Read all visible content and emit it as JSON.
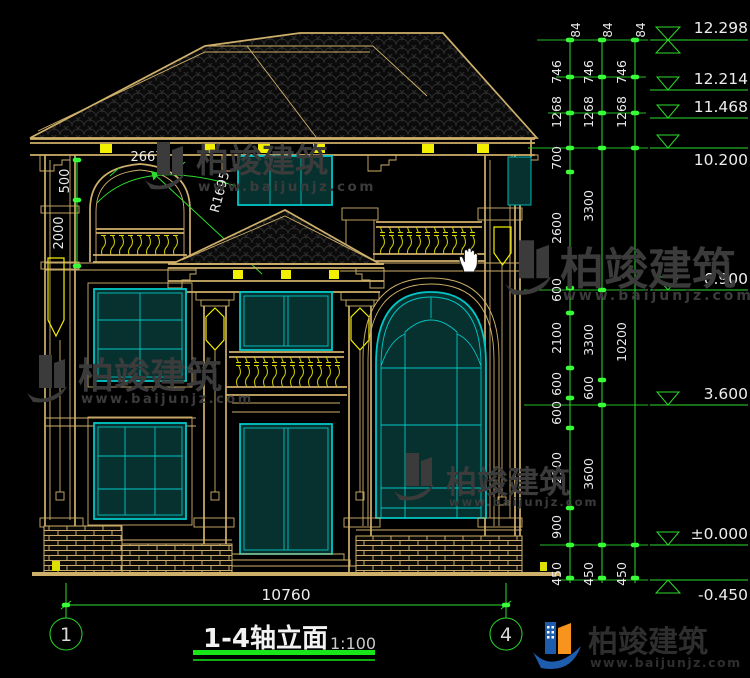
{
  "drawing": {
    "annotations": {
      "arch_width": "2667",
      "arch_offset": "500",
      "arch_height": "2000",
      "arch_radius": "R1695"
    },
    "dimensions": {
      "col1": [
        "84",
        "746",
        "1268",
        "700",
        "2600",
        "600",
        "2100",
        "600",
        "600",
        "2100",
        "900",
        "450"
      ],
      "col2": [
        "84",
        "746",
        "1268",
        "3300",
        "3300",
        "600",
        "3600",
        "450"
      ],
      "col3": [
        "84",
        "746",
        "1268",
        "10200",
        "450"
      ],
      "overall_width": "10760"
    },
    "elevations": [
      "12.298",
      "12.214",
      "11.468",
      "10.200",
      "6.900",
      "3.600",
      "±0.000",
      "-0.450"
    ],
    "grid_bubbles": {
      "left": "1",
      "right": "4"
    }
  },
  "title_block": {
    "title": "1-4轴立面",
    "scale": "1:100"
  },
  "watermark": {
    "name": "柏竣建筑",
    "url": "www.baijunjz.com"
  },
  "logo": {
    "name": "柏竣建筑",
    "url": "www.baijunjz.com"
  },
  "colors": {
    "background": "#000000",
    "dimension_green": "#2bdc2b",
    "line_tan": "#cfb06a",
    "line_yellow": "#f2ef00",
    "window_cyan": "#00c6c6",
    "text_white": "#e9e9e9",
    "watermark_gray": "#3b3b3b",
    "logo_blue": "#1e5cad",
    "logo_orange": "#f7941d"
  }
}
